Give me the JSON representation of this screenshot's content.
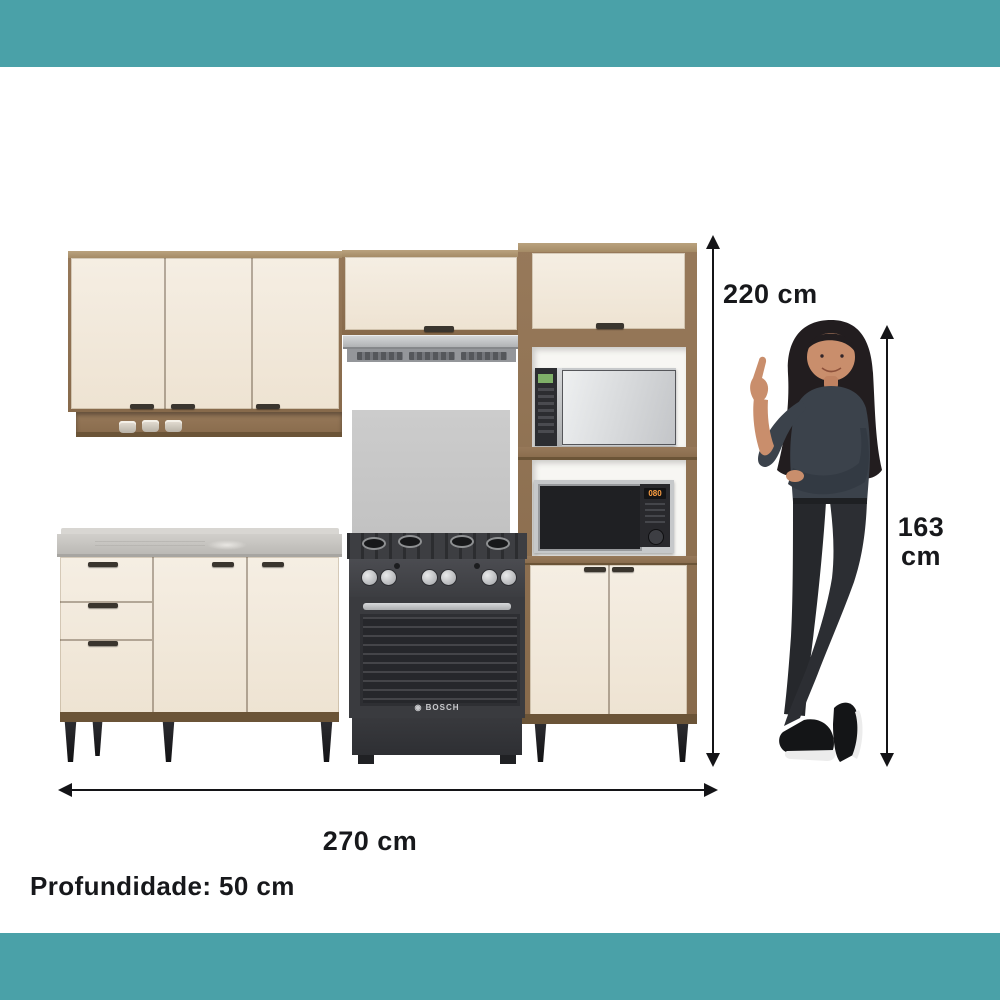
{
  "accent": {
    "bar_color": "#4AA1A8"
  },
  "annotations": {
    "total_height": "220 cm",
    "person_height_value": "163",
    "person_height_unit": "cm",
    "total_width": "270 cm",
    "depth": "Profundidade: 50 cm"
  },
  "appliances": {
    "stove_brand": "BOSCH",
    "microwave_display": "080"
  },
  "product_colors": {
    "door_cream": "#F2E9DC",
    "wood": "#8E7252",
    "countertop_gray": "#C3C1BD",
    "appliance_dark": "#3C3D41"
  }
}
